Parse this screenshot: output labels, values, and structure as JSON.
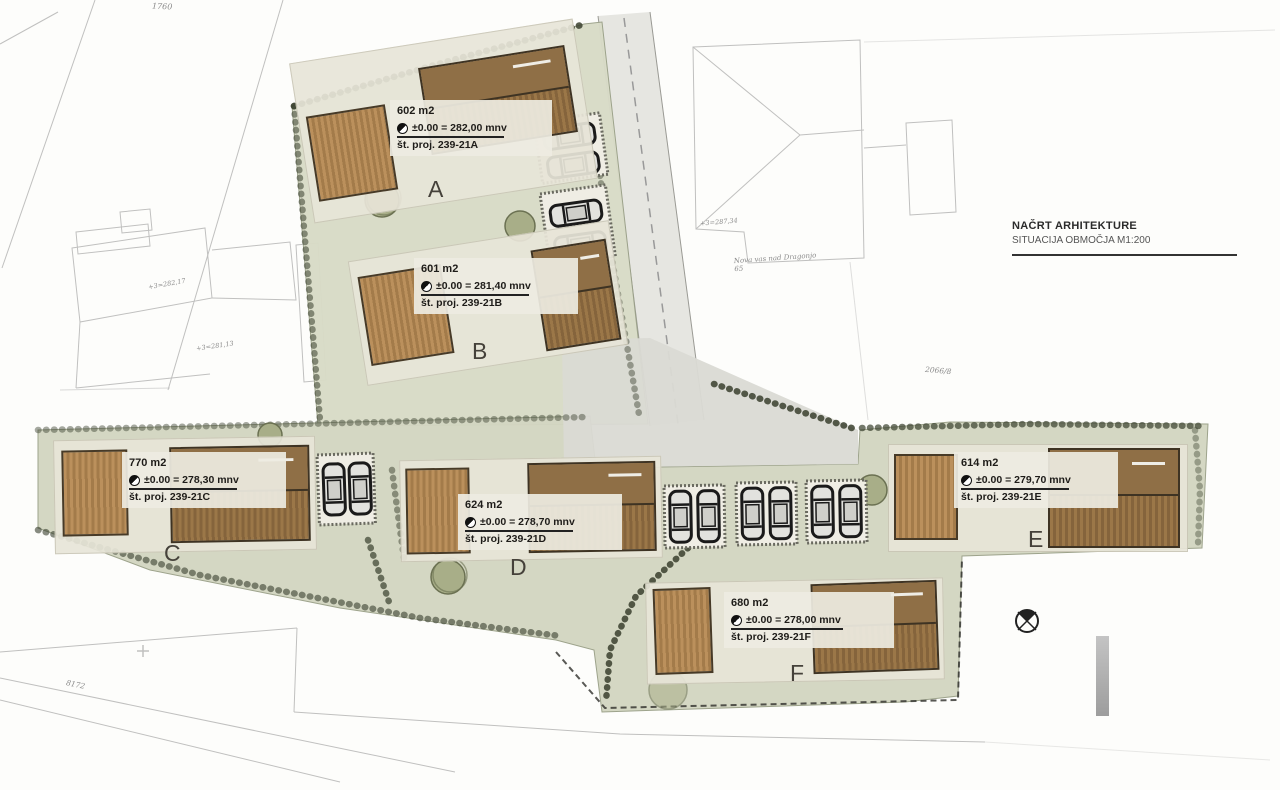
{
  "title_block": {
    "line1": "NAČRT ARHITEKTURE",
    "line2": "SITUACIJA OBMOČJA M1:200"
  },
  "plots": [
    {
      "letter": "A",
      "area": "602 m2",
      "elevation": "±0.00 = 282,00 mnv",
      "project": "št. proj. 239-21A"
    },
    {
      "letter": "B",
      "area": "601 m2",
      "elevation": "±0.00 = 281,40 mnv",
      "project": "št. proj. 239-21B"
    },
    {
      "letter": "C",
      "area": "770 m2",
      "elevation": "±0.00 = 278,30 mnv",
      "project": "št. proj. 239-21C"
    },
    {
      "letter": "D",
      "area": "624 m2",
      "elevation": "±0.00 = 278,70 mnv",
      "project": "št. proj. 239-21D"
    },
    {
      "letter": "E",
      "area": "614 m2",
      "elevation": "±0.00 = 279,70 mnv",
      "project": "št. proj. 239-21E"
    },
    {
      "letter": "F",
      "area": "680 m2",
      "elevation": "±0.00 = 278,00 mnv",
      "project": "št. proj. 239-21F"
    }
  ],
  "annotations": {
    "parcel_number_top_left": "1760",
    "parcel_number_bottom_left": "8172",
    "parcel_number_right": "2066/8",
    "neighbor_house_note": "Nova vas nad Dragonjo 65",
    "elevation_mark_1": "+3=287,34",
    "elevation_mark_2": "+3=282,17",
    "elevation_mark_3": "+3=281,13"
  },
  "colors": {
    "lawn_upper": "#d8dbc7",
    "lawn_lower": "#d3d6c2",
    "pad": "#e8e5d8",
    "wood_dark": "#85643c",
    "wood_light": "#bb905c",
    "road": "#e6e6e1",
    "platform": "#dadad4",
    "shrub": "#39402e",
    "cadastral_line": "#8f8f8f"
  }
}
